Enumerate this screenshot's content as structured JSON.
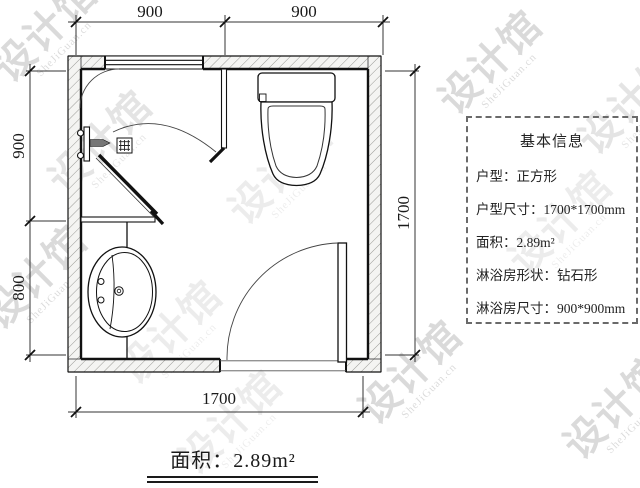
{
  "watermark": {
    "cn": "设计馆",
    "en": "SheJiGuan.cn"
  },
  "plan": {
    "dims": {
      "top_left": "900",
      "top_right": "900",
      "side_top": "900",
      "side_bottom": "800",
      "right": "1700",
      "bottom": "1700"
    },
    "area_label": "面积：2.89m²"
  },
  "info_box": {
    "title": "基本信息",
    "rows": [
      "户型：正方形",
      "户型尺寸：1700*1700mm",
      "面积：2.89m²",
      "淋浴房形状：钻石形",
      "淋浴房尺寸：900*900mm"
    ]
  }
}
